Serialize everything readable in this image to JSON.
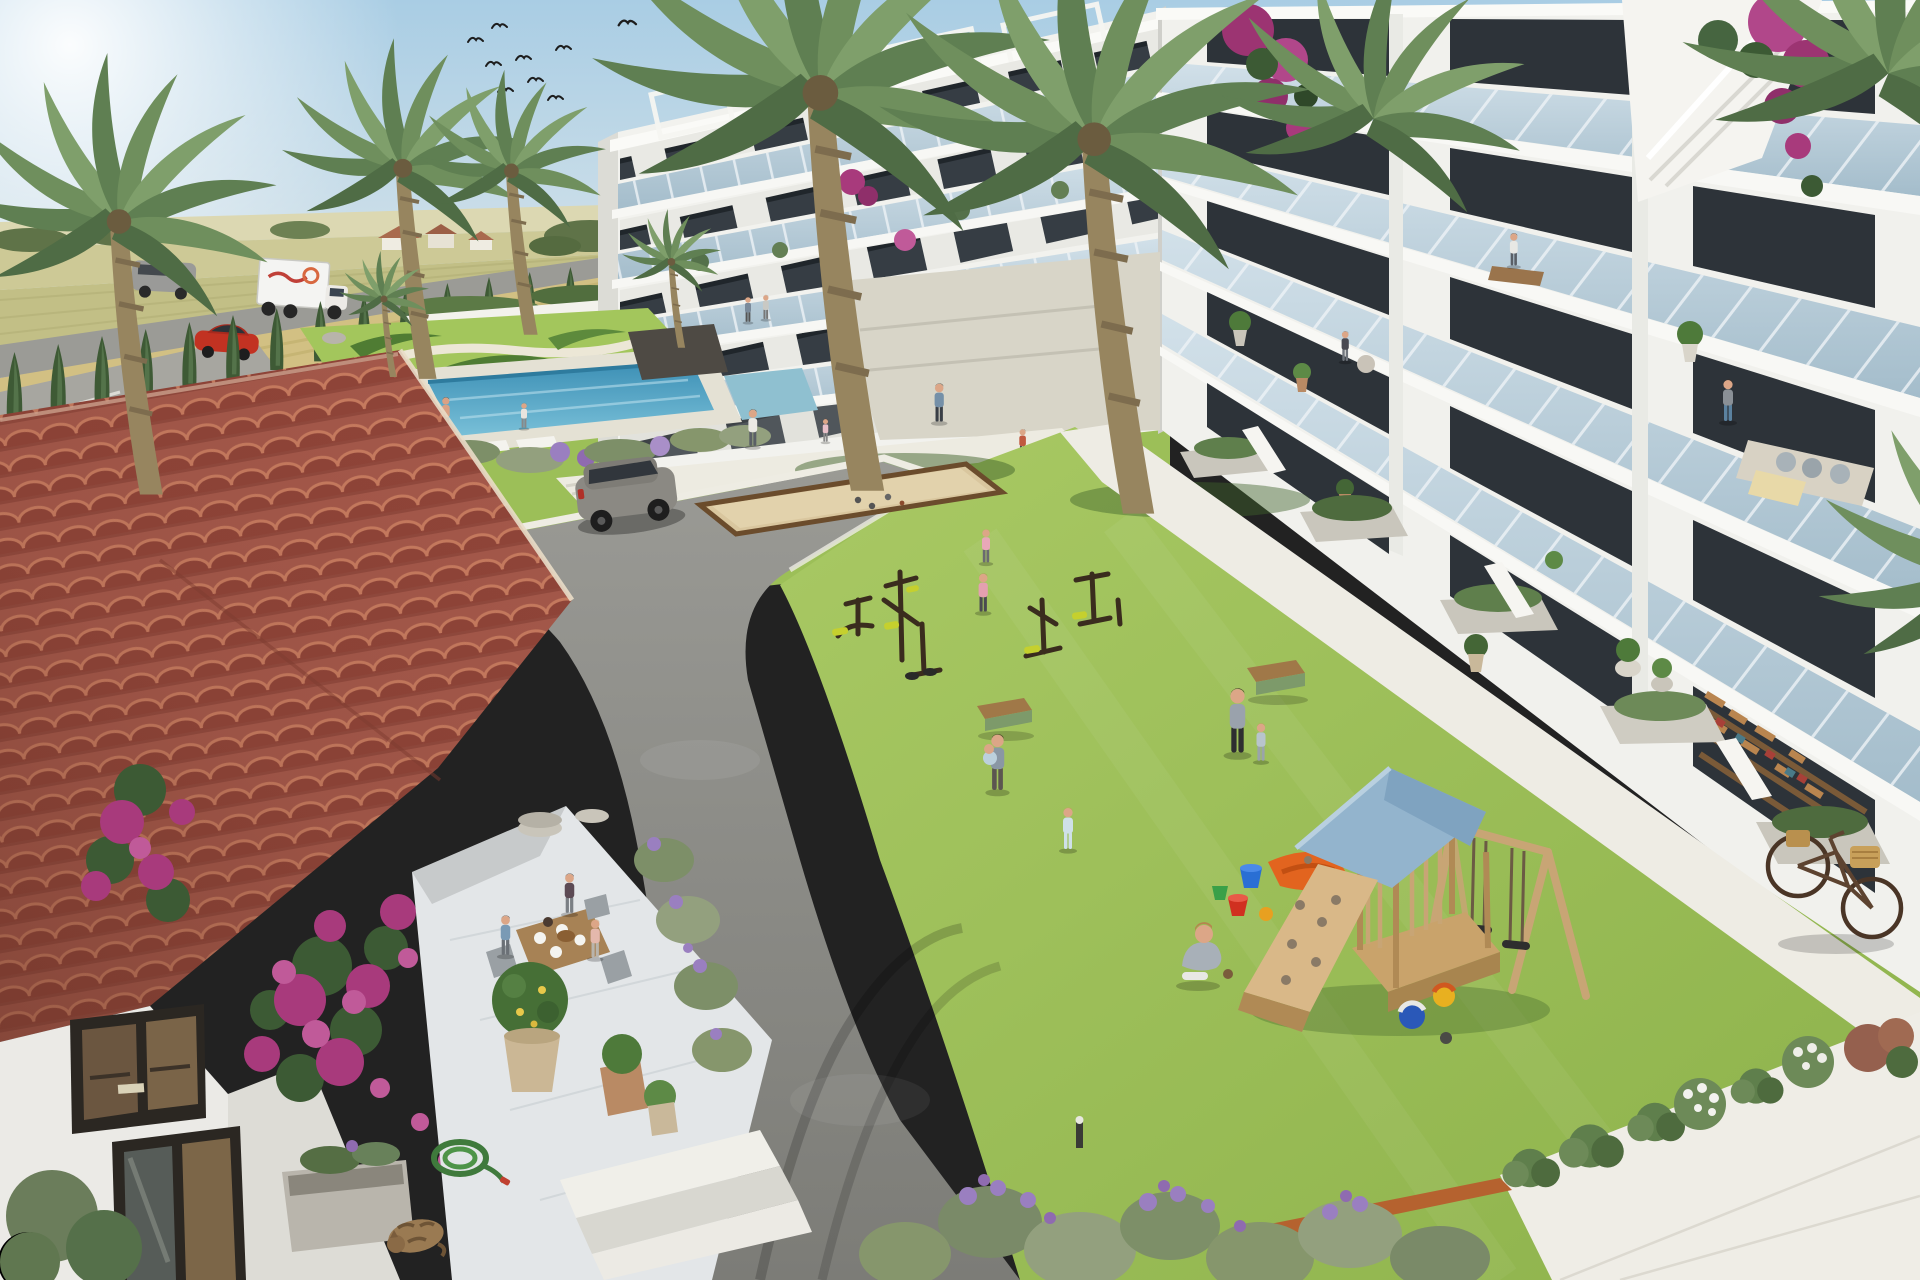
{
  "image": {
    "type": "3d-architectural-rendering",
    "view": "aerial-oblique",
    "subject": "Mediterranean residential complex with central communal garden"
  },
  "scene": {
    "description": "Aerial render of a white modern apartment complex with glass balconies, a terracotta-roof villa with dining terrace, central lawn with playground, outdoor gym, petanque court, pool garden, palm trees and farmland in the background",
    "labels": {
      "sky": "clear blue sky with sun glare upper left",
      "birds": "flock of nine swallows",
      "farmland": "golden and green crop fields with distant farmhouses and trees",
      "distant_road": "perimeter road with white delivery truck and grey van, cypress hedge and parked red car",
      "villa": "terracotta tiled roof villa with white walls, windows and bougainvillea",
      "terrace": "marble dining terrace with three people at a wooden breakfast table, potted orange tree, sleeping cat and garden hose",
      "pool_area": "turquoise pool with bathers, decorative topiary lawn, dark stone palm planter and pond",
      "lawn": "large central lawn with families, benches and bollard lights",
      "gym": "outdoor fitness equipment with two girls exercising",
      "playground": "wooden play tower with blue roof, climbing ramp, orange slide, swing set, buckets and balls, boy crouching",
      "apartments_far": "receding white apartment block with roof pergolas and four balcony floors",
      "apartments_near": "large white apartment block with five floors of glass balconies, residents, plants and bougainvillea",
      "road": "asphalt driveway with grey SUV and tyre marks",
      "petanque": "sand boules court with wooden edge",
      "walkways": "white stone footpaths along the buildings",
      "lavender": "lavender bed with corten steel edging",
      "shrub_border": "flowering shrub border at bottom right",
      "bicycle": "bicycle with wicker baskets parked on the path",
      "palms": "tall palm trees across the garden"
    }
  },
  "palette": {
    "sky_top": "#a9cde4",
    "sky_horizon": "#e9eff1",
    "field_gold": "#cdc488",
    "field_light": "#dcd8b2",
    "field_green": "#b9bd7c",
    "asphalt": "#8d8d89",
    "curb_white": "#eeece3",
    "lawn_light": "#a9c964",
    "lawn_dark": "#84a844",
    "topiary_dark": "#4f7c33",
    "pool_water": "#4899bd",
    "pond": "#8fc0d0",
    "roof_tile": "#a4584a",
    "roof_tile_dark": "#8f4438",
    "roof_tile_light": "#c77b5f",
    "villa_wall": "#ebeae6",
    "terrace_marble": "#e3e6e8",
    "building_white": "#f2f2ee",
    "glass_railing": "#b7ccd9",
    "window_dark": "#31383e",
    "bougainvillea": "#a83a7c",
    "lavender_flower": "#9a7fc0",
    "playground_wood": "#c9a36b",
    "play_roof_blue": "#93b4cd",
    "slide_orange": "#e2641f",
    "sand_court": "#d9c69e",
    "suv_grey": "#8b8983",
    "red_car": "#c23222",
    "truck_white": "#f4f4f2",
    "palm_frond": "#6f8f5d",
    "palm_trunk": "#97855f",
    "cypress": "#3e5a35",
    "table_wood": "#b08a5c",
    "cat": "#9a7a52",
    "hose": "#3f7a3c",
    "corten_edge": "#b5622f"
  },
  "counts": {
    "birds": 9,
    "large_palms": 5,
    "small_palms": 2,
    "cypress_trees": 17,
    "benches": 2,
    "swings": 2,
    "play_balls": 3,
    "buckets": 4,
    "vehicles": {
      "suv": 1,
      "red_car": 1,
      "box_truck": 1,
      "van": 1,
      "bicycle": 1
    },
    "cats": 1
  }
}
